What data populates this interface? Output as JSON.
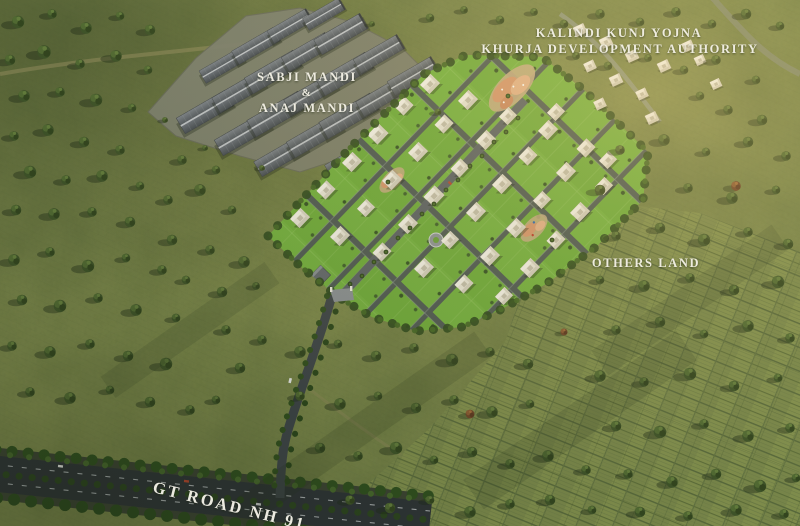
{
  "labels": {
    "authority_line1": "KALINDI KUNJ YOJNA",
    "authority_line2": "KHURJA DEVELOPMENT AUTHORITY",
    "mandi_line1": "SABJI MANDI",
    "mandi_line2": "&",
    "mandi_line3": "ANAJ MANDI",
    "others_land": "OTHERS LAND",
    "highway": "GT ROAD NH 91"
  },
  "palette": {
    "field_green": "#7e8a4e",
    "highlight_green": "#b3b572",
    "tree_green": "#3f5429",
    "township_lawn": "#6fae3b",
    "road_asphalt": "#2e3437",
    "township_road": "#4b5357",
    "warehouse_roof": "#565d64",
    "villa_white": "#ece9dc",
    "amenity_canopy": "#d9986f",
    "label_text": "#f4f1e6"
  }
}
